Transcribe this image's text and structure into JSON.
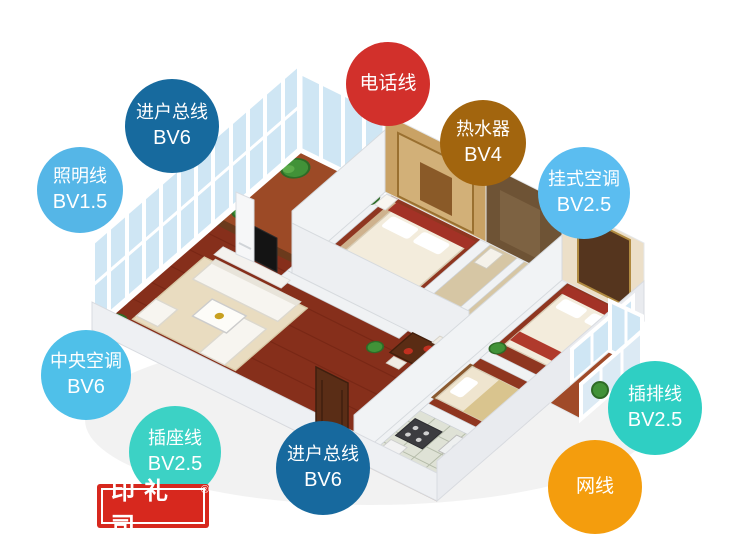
{
  "badges": [
    {
      "id": "telephone-line",
      "label": "电话线",
      "value": "",
      "color": "#d2302b",
      "x": 388,
      "y": 84,
      "r": 42
    },
    {
      "id": "incoming-main-line-top",
      "label": "进户总线",
      "value": "BV6",
      "color": "#176a9e",
      "x": 172,
      "y": 126,
      "r": 47
    },
    {
      "id": "lighting-line",
      "label": "照明线",
      "value": "BV1.5",
      "color": "#55b6e7",
      "x": 80,
      "y": 190,
      "r": 43
    },
    {
      "id": "water-heater",
      "label": "热水器",
      "value": "BV4",
      "color": "#a2650e",
      "x": 483,
      "y": 143,
      "r": 43
    },
    {
      "id": "wall-mounted-ac",
      "label": "挂式空调",
      "value": "BV2.5",
      "color": "#5bbdf0",
      "x": 584,
      "y": 193,
      "r": 46
    },
    {
      "id": "central-ac",
      "label": "中央空调",
      "value": "BV6",
      "color": "#4fc0e9",
      "x": 86,
      "y": 375,
      "r": 45
    },
    {
      "id": "socket-line",
      "label": "插座线",
      "value": "BV2.5",
      "color": "#3cd2c5",
      "x": 175,
      "y": 452,
      "r": 46
    },
    {
      "id": "incoming-main-line-bottom",
      "label": "进户总线",
      "value": "BV6",
      "color": "#17699e",
      "x": 323,
      "y": 468,
      "r": 47
    },
    {
      "id": "power-strip-line",
      "label": "插排线",
      "value": "BV2.5",
      "color": "#2fcfc3",
      "x": 655,
      "y": 408,
      "r": 47
    },
    {
      "id": "network-cable",
      "label": "网线",
      "value": "",
      "color": "#f49d0d",
      "x": 595,
      "y": 487,
      "r": 47
    }
  ],
  "stamp": {
    "text": "印礼司",
    "registered": "®",
    "background": "#d7281e",
    "text_color": "#ffffff"
  },
  "floorplan_palette": {
    "wood_floor": "#862f1b",
    "walls": "#eef0f3",
    "glass": "#cfe6f4",
    "bed_accent": "#a33226",
    "headboard_wall": "#c9a265",
    "bath_wall": "#6e5335",
    "plant": "#419238"
  }
}
